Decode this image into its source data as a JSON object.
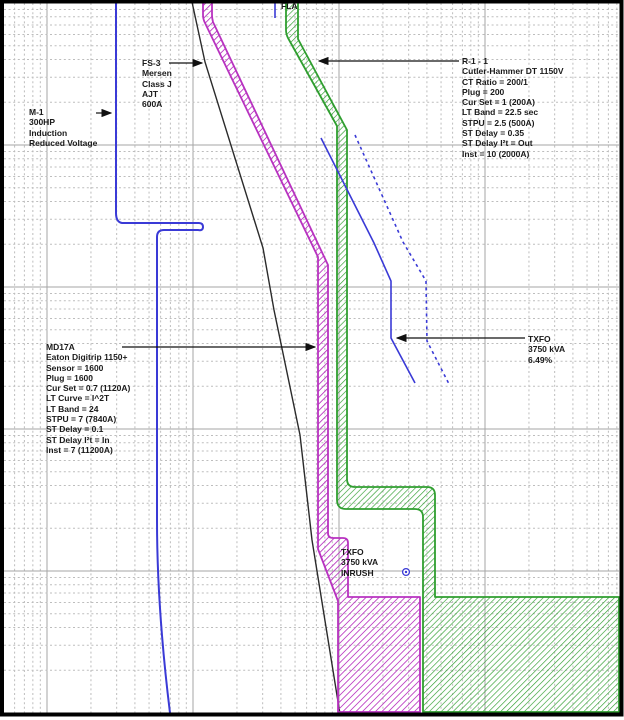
{
  "colors": {
    "md17a_band_magenta": "#b832c0",
    "r1_1_band_green": "#2f9e2f",
    "curve_blue": "#3a3ad6",
    "fuse_black": "#2b2b2b",
    "grid_major": "#a6a6a6",
    "grid_minor": "#bdbdbd",
    "label_text": "#1a1a1a"
  },
  "labels": {
    "fla": {
      "text": "FLA"
    },
    "m1": {
      "lines": [
        "M-1",
        "300HP",
        "Induction",
        "Reduced Voltage"
      ]
    },
    "fs3": {
      "lines": [
        "FS-3",
        "Mersen",
        "Class J",
        "AJT",
        "600A"
      ]
    },
    "r1_1": {
      "lines": [
        "R-1 - 1",
        "Cutler-Hammer DT 1150V",
        "CT Ratio = 200/1",
        "Plug = 200",
        "Cur Set = 1 (200A)",
        "LT Band = 22.5 sec",
        "STPU = 2.5 (500A)",
        "ST Delay = 0.35",
        "ST Delay I²t = Out",
        "Inst = 10 (2000A)"
      ]
    },
    "md17a": {
      "lines": [
        "MD17A",
        "Eaton Digitrip 1150+",
        "Sensor = 1600",
        "Plug = 1600",
        "Cur Set = 0.7 (1120A)",
        "LT Curve = I^2T",
        "LT Band = 24",
        "STPU = 7 (7840A)",
        "ST Delay = 0.1",
        "ST Delay I²t = In",
        "Inst = 7 (11200A)"
      ]
    },
    "txfo": {
      "lines": [
        "TXFO",
        "3750 kVA",
        "6.49%"
      ]
    },
    "txfo_inrush": {
      "lines": [
        "TXFO",
        "3750 kVA",
        "INRUSH"
      ]
    }
  },
  "chart_data": {
    "type": "line",
    "title": "",
    "xlabel": "",
    "ylabel": "",
    "axes": {
      "x_scale": "log",
      "y_scale": "log",
      "tick_labels_visible": false,
      "grid": "log-log graph paper, dashed minor lines, solid decade lines"
    },
    "legend_position": "none (leader-line annotations on plot)",
    "series": [
      {
        "name": "M-1 motor starting curve",
        "device": "M-1 300HP Induction Reduced Voltage",
        "color": "#3a3ad6",
        "style": "solid",
        "shape": "vertical FLA line with locked-rotor step then run-down to bottom"
      },
      {
        "name": "FS-3 fuse curve",
        "device": "FS-3 Mersen Class J AJT 600A",
        "color": "#2b2b2b",
        "style": "solid",
        "shape": "steep diagonal from top-left toward bottom-center"
      },
      {
        "name": "MD17A breaker band",
        "device": "Eaton Digitrip 1150+",
        "color": "#b832c0",
        "style": "hatched-band",
        "settings": {
          "Sensor": "1600",
          "Plug": "1600",
          "Cur Set": "0.7 (1120A)",
          "LT Curve": "I^2T",
          "LT Band": "24",
          "STPU": "7 (7840A)",
          "ST Delay": "0.1",
          "ST Delay I2t": "In",
          "Inst": "7 (11200A)"
        }
      },
      {
        "name": "R-1 - 1 relay band",
        "device": "Cutler-Hammer DT 1150V",
        "color": "#2f9e2f",
        "style": "hatched-band",
        "settings": {
          "CT Ratio": "200/1",
          "Plug": "200",
          "Cur Set": "1 (200A)",
          "LT Band": "22.5 sec",
          "STPU": "2.5 (500A)",
          "ST Delay": "0.35",
          "ST Delay I2t": "Out",
          "Inst": "10 (2000A)"
        }
      },
      {
        "name": "TXFO damage curve",
        "device": "TXFO 3750 kVA 6.49%",
        "color": "#3a3ad6",
        "style": "solid"
      },
      {
        "name": "TXFO damage curve shifted",
        "device": "TXFO 3750 kVA",
        "color": "#3a3ad6",
        "style": "dashed"
      },
      {
        "name": "TXFO inrush point",
        "device": "TXFO 3750 kVA INRUSH",
        "color": "#3a3ad6",
        "style": "circle-dot marker"
      },
      {
        "name": "FLA marker",
        "device": "M-1 full load amps tick",
        "color": "#3a3ad6",
        "style": "short vertical tick at top"
      }
    ]
  }
}
